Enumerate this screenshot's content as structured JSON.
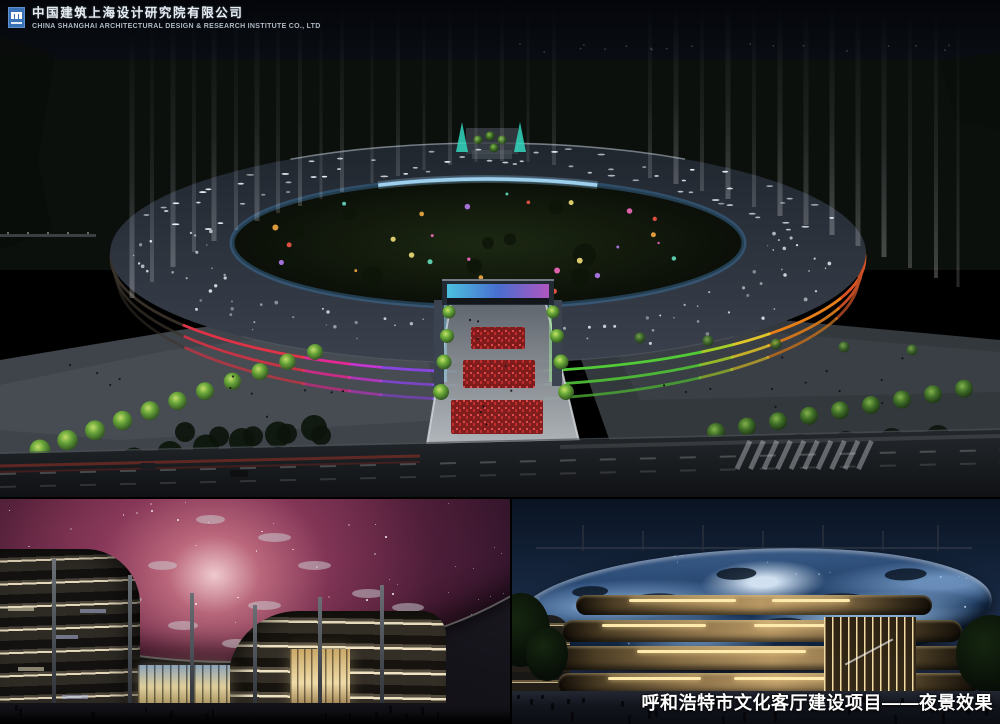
{
  "header": {
    "company_name_cn": "中国建筑上海设计研究院有限公司",
    "company_name_en": "CHINA SHANGHAI ARCHITECTURAL DESIGN & RESEARCH INSTITUTE CO., LTD"
  },
  "caption": "呼和浩特市文化客厅建设项目——夜景效果",
  "colors": {
    "logo_blue": "#3a72b8",
    "sky_top": "#03050a",
    "roof_slate": "#2b323c",
    "band_red": "#e8354a",
    "band_magenta": "#ea2a9a",
    "band_violet": "#c838d8",
    "band_purple": "#8a48e8",
    "band_blue": "#3f9ef0",
    "band_green": "#52d438",
    "band_yellowgreen": "#aad828",
    "band_yellow": "#e8cc2a",
    "band_orange": "#f08418",
    "band_orangered": "#e85525",
    "glass_ring_blue": "#a8dcf8",
    "nebula_pink": "#c4607a",
    "starry_blue": "#7fa8d8",
    "facade_gold": "#d8bc80"
  }
}
